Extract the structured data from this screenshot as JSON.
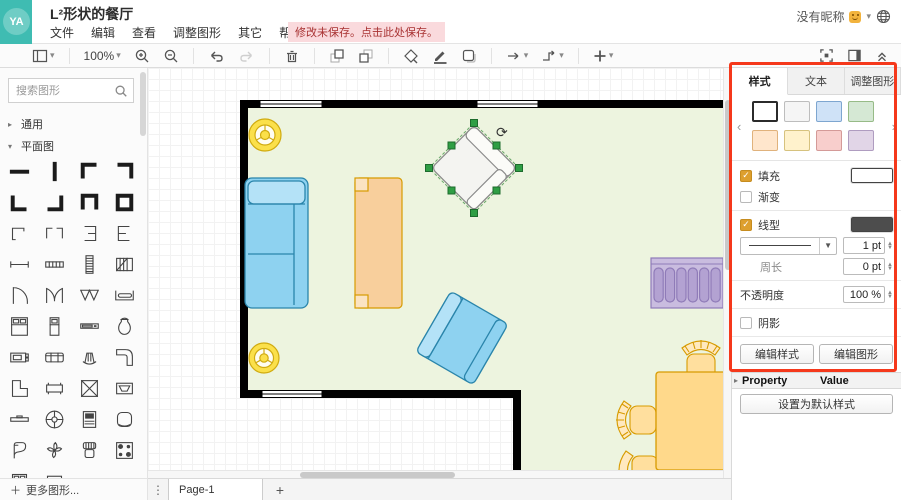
{
  "header": {
    "avatar_text": "YA",
    "title": "L²形状的餐厅",
    "menu": [
      {
        "name": "file",
        "label": "文件"
      },
      {
        "name": "edit",
        "label": "编辑"
      },
      {
        "name": "view",
        "label": "查看"
      },
      {
        "name": "arrange",
        "label": "调整图形"
      },
      {
        "name": "extras",
        "label": "其它"
      },
      {
        "name": "help",
        "label": "帮助"
      }
    ],
    "unsaved_badge": "修改未保存。点击此处保存。",
    "user_label": "没有昵称"
  },
  "toolbar": {
    "zoom_level": "100%"
  },
  "icons": {
    "caret": "▾",
    "kebab": "⋮",
    "chevron_left": "‹",
    "chevron_right": "›",
    "plus": "+",
    "more_plus": "＋",
    "triangle": "▸",
    "stepper_up": "▲",
    "stepper_down": "▼",
    "dropdown": "▼",
    "check": "✓",
    "rotate": "⟳"
  },
  "sidebar": {
    "search_placeholder": "搜索图形",
    "sections": [
      {
        "name": "general",
        "label": "通用",
        "caret": "▸"
      },
      {
        "name": "floorplan",
        "label": "平面图",
        "caret": "▾"
      }
    ],
    "more_label": "更多图形...",
    "shapes": [
      "wall",
      "wall-vertical",
      "corner-nw",
      "corner-ne",
      "corner-sw",
      "corner-se",
      "wall-u",
      "room",
      "corner-thin",
      "corner-double",
      "wall-e-left",
      "wall-e-right",
      "wall-thin",
      "window",
      "stairs",
      "stairs-turn",
      "door",
      "door-double",
      "door-bifold",
      "sliding-door",
      "bed-double",
      "bed-single",
      "flat-tv",
      "bag",
      "tv-stand",
      "sofa",
      "armchair-fan",
      "counter-l",
      "shape-l",
      "table",
      "table-x",
      "fireplace",
      "shelf",
      "stairs-spiral",
      "dresser",
      "ottoman",
      "piano",
      "plant",
      "chair",
      "stove",
      "bed-cut",
      "cabinet-cut"
    ]
  },
  "canvas": {
    "objects": [
      "l-shaped-room",
      "window",
      "ceiling-lamp",
      "ceiling-lamp",
      "sofa-blue",
      "couch-orange",
      "armchair-selected",
      "armchair-blue",
      "radiator-couch-purple",
      "dining-table",
      "dining-chair",
      "dining-chair",
      "dining-chair"
    ]
  },
  "panel": {
    "tabs": [
      {
        "name": "style",
        "label": "样式",
        "active": true
      },
      {
        "name": "text",
        "label": "文本",
        "active": false
      },
      {
        "name": "arrange",
        "label": "调整图形",
        "active": false
      }
    ],
    "swatches": [
      {
        "name": "white",
        "fill": "#ffffff",
        "stroke": "#2b2b2b",
        "selected": true
      },
      {
        "name": "gray",
        "fill": "#f5f5f5",
        "stroke": "#bdbdbd",
        "selected": false
      },
      {
        "name": "blue",
        "fill": "#cfe2f7",
        "stroke": "#7ea6d0",
        "selected": false
      },
      {
        "name": "green",
        "fill": "#d5e8d4",
        "stroke": "#97bb87",
        "selected": false
      },
      {
        "name": "orange",
        "fill": "#ffe6cc",
        "stroke": "#e0b27c",
        "selected": false
      },
      {
        "name": "yellow",
        "fill": "#fff2cc",
        "stroke": "#d6c27e",
        "selected": false
      },
      {
        "name": "red",
        "fill": "#f8cecc",
        "stroke": "#d49a98",
        "selected": false
      },
      {
        "name": "purple",
        "fill": "#e1d5e7",
        "stroke": "#af9cc0",
        "selected": false
      }
    ],
    "fill": {
      "label": "填充",
      "checked": true,
      "swatch_color": "#ffffff"
    },
    "gradient": {
      "label": "渐变",
      "checked": false
    },
    "line": {
      "label": "线型",
      "checked": true,
      "swatch_color": "#4d4d4d",
      "width_value": "1 pt"
    },
    "perimeter": {
      "label": "周长",
      "value": "0 pt"
    },
    "opacity": {
      "label": "不透明度",
      "value": "100 %"
    },
    "shadow": {
      "label": "阴影",
      "checked": false
    },
    "style_buttons": [
      {
        "name": "edit-style",
        "label": "编辑样式"
      },
      {
        "name": "edit-shape",
        "label": "编辑图形"
      },
      {
        "name": "copy-style",
        "label": "复制风格"
      },
      {
        "name": "paste-style",
        "label": "粘贴样式"
      }
    ],
    "default_style_button": "设置为默认样式",
    "property_header": "Property",
    "value_header": "Value"
  },
  "footer": {
    "page_tab": "Page-1"
  },
  "colors": {
    "accent_teal": "#3fbcb2",
    "annotation_red": "#f5381b",
    "room_fill": "#edf4df",
    "wall": "#000000",
    "blue": "#8ed2f0",
    "blue_light": "#b4e2f7",
    "blue_stroke": "#2a85ab",
    "orange": "#f8cf9c",
    "orange_light": "#fbe3c2",
    "orange_stroke": "#d79b00",
    "purple": "#c9bcdf",
    "purple_dark": "#b3a2d2",
    "purple_stroke": "#8f7bb8",
    "table": "#ffd98b",
    "chair": "#ffdf9e",
    "chair_light": "#ffe9bf",
    "lamp": "#fbe04a",
    "lamp_stroke": "#d0ab10",
    "selection": "#2f9e44",
    "selection_dark": "#1d6b2d"
  }
}
